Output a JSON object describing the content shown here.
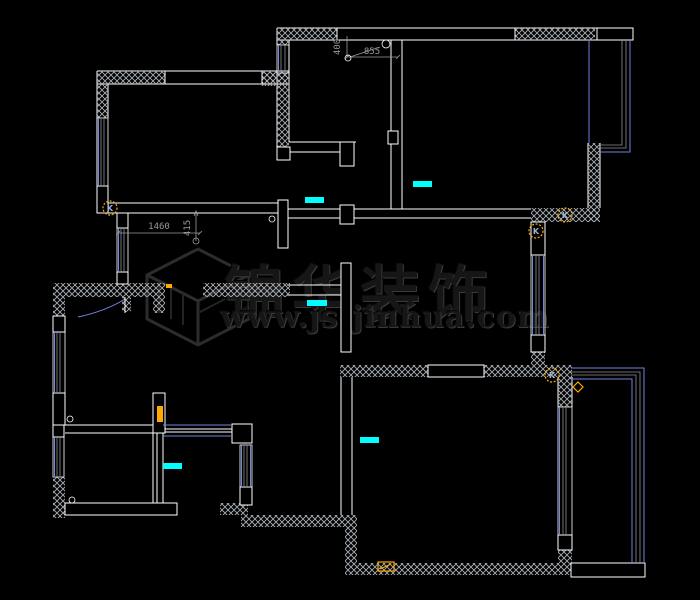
{
  "canvas": {
    "width": 700,
    "height": 600
  },
  "watermark": {
    "brand": "锦华装饰",
    "url": "www.js-jinhua.com"
  },
  "dims": {
    "d1460": "1460",
    "d415": "415",
    "d855": "855",
    "d400": "400"
  },
  "symbols": {
    "switch_label": "K"
  },
  "colors": {
    "bg": "#000000",
    "wall": "#ffffff",
    "gray": "#8f8f8f",
    "window": "#7285dd",
    "hatch": "#aab0b6",
    "marker": "#00ffff",
    "symbol": "#ffaa00",
    "dim": "#9a9a9a",
    "watermark": "#161616",
    "watermark_hi": "#3a3a3a"
  }
}
